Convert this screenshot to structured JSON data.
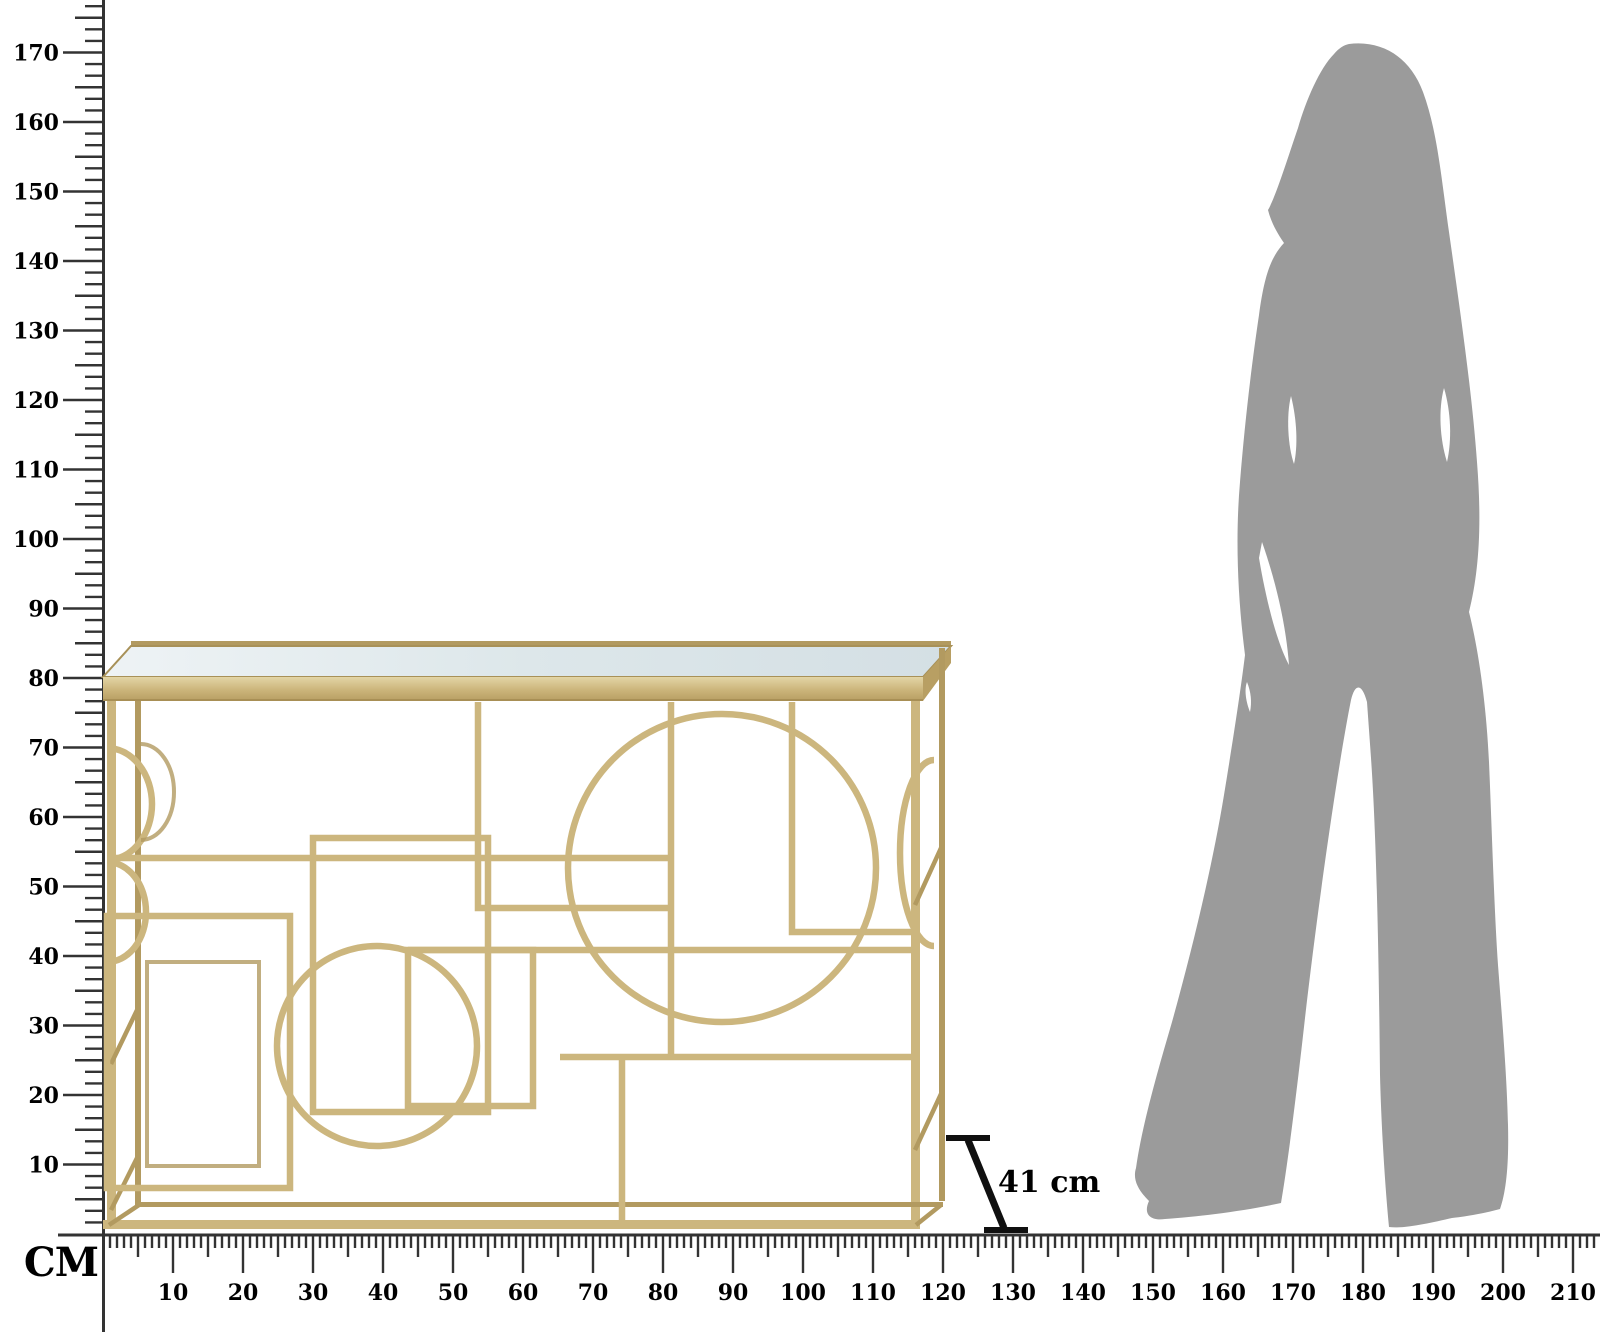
{
  "canvas": {
    "width": 1600,
    "height": 1336,
    "background": "#ffffff"
  },
  "colors": {
    "gold": "#ccb67e",
    "gold-dark": "#b29a60",
    "gold-light": "#e8dcb2",
    "mirror": "#dbe5e9",
    "silhouette": "#9b9b9b",
    "ruler-line": "#333333",
    "label-ink": "#000000"
  },
  "rulers": {
    "unit_label": "CM",
    "origin_x": 103,
    "origin_y": 1234,
    "vertical": {
      "px_per_cm": 6.95,
      "minor_divisions_per_10cm": 6,
      "tick_labels": [
        10,
        20,
        30,
        40,
        50,
        60,
        70,
        80,
        90,
        100,
        110,
        120,
        130,
        140,
        150,
        160,
        170
      ]
    },
    "horizontal": {
      "px_per_cm": 7.0,
      "minor_divisions_per_10cm": 10,
      "tick_labels": [
        10,
        20,
        30,
        40,
        50,
        60,
        70,
        80,
        90,
        100,
        110,
        120,
        130,
        140,
        150,
        160,
        170,
        180,
        190,
        200,
        210
      ]
    }
  },
  "annotation": {
    "depth_label": "41 cm"
  },
  "product": {
    "kind": "gold geometric console table with mirrored top",
    "frame_color": "#ccb67e",
    "mirror_color": "#dbe5e9"
  },
  "silhouette": {
    "kind": "standing woman, long hair, wide-leg trousers",
    "color": "#9b9b9b"
  }
}
